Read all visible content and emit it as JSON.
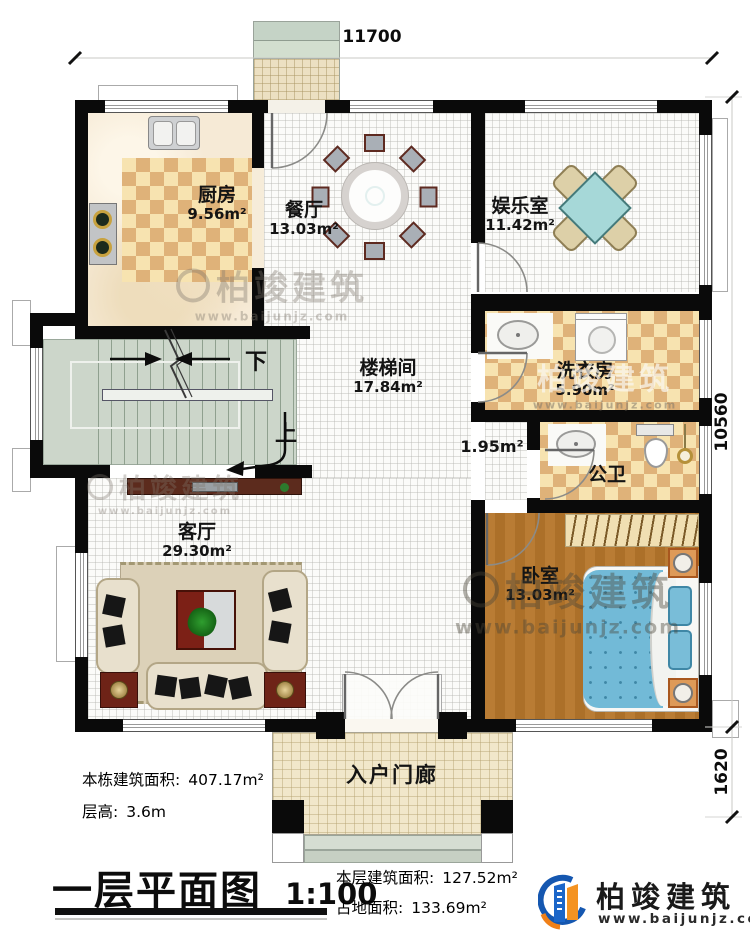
{
  "plan": {
    "dim_top": "11700",
    "dim_right_main": "10560",
    "dim_right_porch": "1620",
    "rooms": {
      "kitchen": {
        "name": "厨房",
        "area": "9.56m²"
      },
      "dining": {
        "name": "餐厅",
        "area": "13.03m²"
      },
      "entertainment": {
        "name": "娱乐室",
        "area": "11.42m²"
      },
      "stairwell": {
        "name": "楼梯间",
        "area": "17.84m²"
      },
      "laundry": {
        "name": "洗衣房",
        "area": "5.90m²"
      },
      "bathroom": {
        "name": "公卫",
        "area": "3.64m²"
      },
      "hall_nook": {
        "area": "1.95m²"
      },
      "living": {
        "name": "客厅",
        "area": "29.30m²"
      },
      "bedroom": {
        "name": "卧室",
        "area": "13.03m²"
      },
      "porch": {
        "name": "入户门廊"
      }
    },
    "stairs": {
      "down": "下",
      "up": "上"
    }
  },
  "info": {
    "building_total": {
      "label": "本栋建筑面积:",
      "value": "407.17m²"
    },
    "floor_height": {
      "label": "层高:",
      "value": "3.6m"
    },
    "floor_area": {
      "label": "本层建筑面积:",
      "value": "127.52m²"
    },
    "land_area": {
      "label": "占地面积:",
      "value": "133.69m²"
    }
  },
  "title": {
    "text": "一层平面图",
    "scale": "1:100"
  },
  "brand": {
    "name": "柏竣建筑",
    "website": "www.baijunjz.com"
  }
}
